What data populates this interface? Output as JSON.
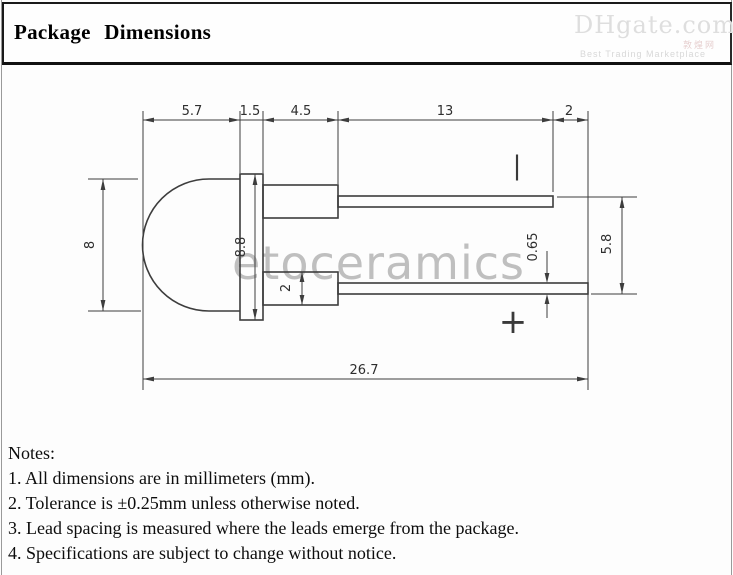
{
  "title": "Package Dimensions",
  "watermarks": {
    "brand": "etoceramics",
    "logo_main": "DHgate.com",
    "logo_cn": "敦煌网",
    "logo_tagline": "Best Trading Marketplace"
  },
  "drawing": {
    "dims_top": [
      "5.7",
      "1.5",
      "4.5",
      "13",
      "2"
    ],
    "dim_dome_diameter": "8",
    "dim_flange_diameter": "8.8",
    "dim_lead_emerge_width": "2",
    "dim_lead_thickness": "0.65",
    "dim_lead_outer_span": "5.8",
    "dim_overall_length": "26.7",
    "cathode_mark": "|",
    "anode_mark": "+"
  },
  "notes": {
    "heading": "Notes:",
    "items": [
      "1. All dimensions are in millimeters (mm).",
      "2. Tolerance is ±0.25mm unless otherwise noted.",
      "3. Lead spacing is measured where the leads emerge from the package.",
      "4. Specifications are subject to change without notice."
    ]
  }
}
